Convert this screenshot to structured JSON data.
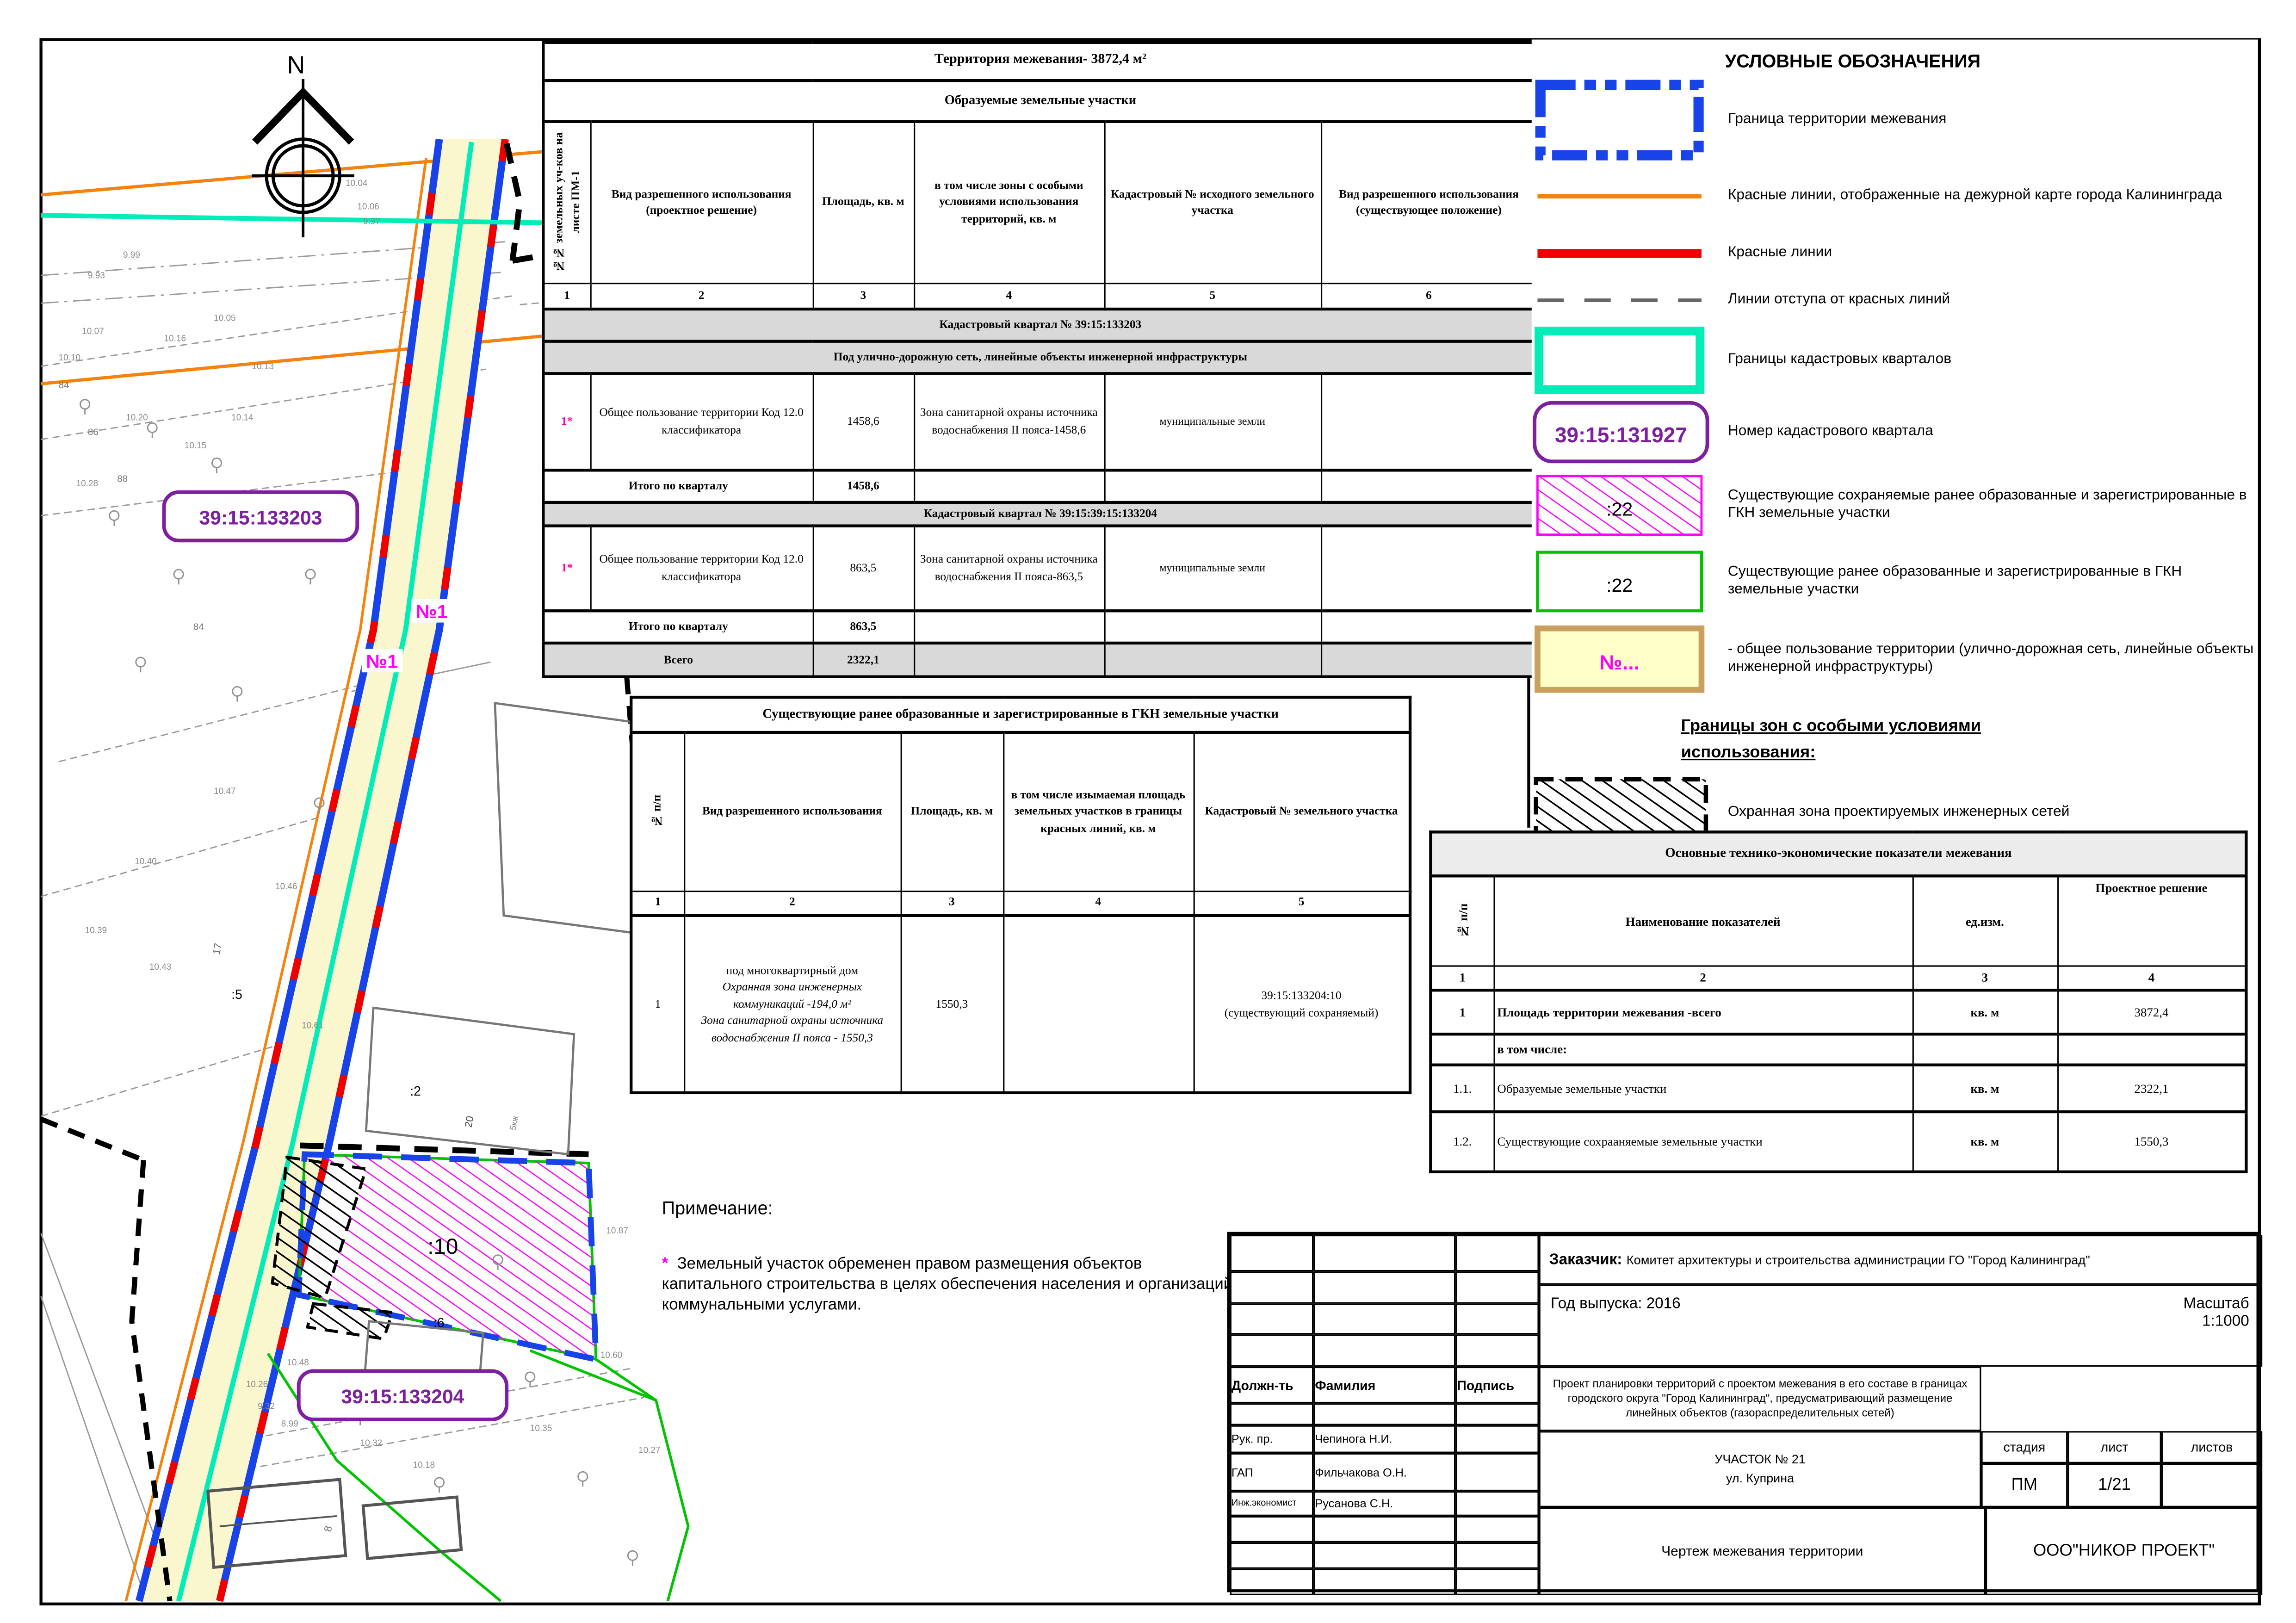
{
  "map": {
    "compass": "N",
    "quarter_label_1": "39:15:133203",
    "quarter_label_2": "39:15:133204",
    "parcel_no1": "№1",
    "parcel_10": ":10",
    "parcel_2": ":2",
    "parcel_5": ":5",
    "parcel_6": ":6",
    "house_17": "17",
    "house_20": "20",
    "house_8": "8",
    "house_84": "84",
    "house_86": "86",
    "house_88": "88",
    "house_5kzh": "5кж",
    "elevations": [
      "10.04",
      "10.06",
      "9.97",
      "9.99",
      "9.93",
      "10.05",
      "10.16",
      "10.07",
      "10.10",
      "10.13",
      "10.20",
      "10.14",
      "10.15",
      "10.28",
      "10.47",
      "10.40",
      "10.46",
      "10.39",
      "10.43",
      "10.61",
      "10.87",
      "10.60",
      "10.45",
      "10.44",
      "10.35",
      "10.27",
      "10.32",
      "10.18",
      "10.48",
      "10.26",
      "9.32",
      "10.36",
      "8.99"
    ]
  },
  "table1": {
    "title": "Территория межевания- 3872,4 м²",
    "subtitle": "Образуемые земельные участки",
    "headers": [
      "№№ земельных уч-ков на листе ПМ-1",
      "Вид разрешенного использования (проектное решение)",
      "Площадь, кв. м",
      "в том числе зоны с особыми условиями использования территорий, кв. м",
      "Кадастровый № исходного земельного участка",
      "Вид разрешенного использования (существующее положение)"
    ],
    "col_numbers": [
      "1",
      "2",
      "3",
      "4",
      "5",
      "6"
    ],
    "section1": "Кадастровый квартал № 39:15:133203",
    "section1_sub": "Под улично-дорожную сеть, линейные объекты инженерной инфраструктуры",
    "row1": {
      "num": "1*",
      "use": "Общее пользование территории Код 12.0 классификатора",
      "area": "1458,6",
      "zone": "Зона санитарной охраны источника водоснабжения II пояса-1458,6",
      "source": "муниципальные земли",
      "existing": ""
    },
    "subtotal1_label": "Итого по кварталу",
    "subtotal1_value": "1458,6",
    "section2": "Кадастровый квартал № 39:15:39:15:133204",
    "row2": {
      "num": "1*",
      "use": "Общее пользование территории Код 12.0 классификатора",
      "area": "863,5",
      "zone": "Зона санитарной охраны источника водоснабжения II пояса-863,5",
      "source": "муниципальные земли",
      "existing": ""
    },
    "subtotal2_label": "Итого по кварталу",
    "subtotal2_value": "863,5",
    "total_label": "Всего",
    "total_value": "2322,1"
  },
  "table2": {
    "title": "Существующие ранее образованные и зарегистрированные в ГКН земельные участки",
    "headers": [
      "№ п/п",
      "Вид разрешенного использования",
      "Площадь, кв. м",
      "в том числе изымаемая площадь земельных участков в границы красных линий, кв. м",
      "Кадастровый № земельного участка"
    ],
    "col_numbers": [
      "1",
      "2",
      "3",
      "4",
      "5"
    ],
    "row": {
      "num": "1",
      "use_line1": "под многоквартирный дом",
      "use_line2": "Охранная зона инженерных коммуникаций -194,0 м²",
      "use_line3": "Зона санитарной охраны источника водоснабжения II пояса - 1550,3",
      "area": "1550,3",
      "seized": "",
      "cadastre_line1": "39:15:133204:10",
      "cadastre_line2": "(существующий сохраняемый)"
    }
  },
  "legend": {
    "title": "УСЛОВНЫЕ ОБОЗНАЧЕНИЯ",
    "items": [
      {
        "label": "Граница территории межевания"
      },
      {
        "label": "Красные линии, отображенные на дежурной карте города Калининграда"
      },
      {
        "label": "Красные линии"
      },
      {
        "label": "Линии отступа от красных линий"
      },
      {
        "label": "Границы кадастровых кварталов"
      },
      {
        "symbol": "39:15:131927",
        "label": "Номер кадастрового квартала"
      },
      {
        "symbol": ":22",
        "label": "Существующие сохраняемые ранее образованные и зарегистрированные в ГКН земельные участки"
      },
      {
        "symbol": ":22",
        "label": "Существующие ранее образованные и зарегистрированные в ГКН земельные участки"
      },
      {
        "symbol": "№...",
        "label": "- общее пользование территории (улично-дорожная сеть, линейные объекты инженерной инфраструктуры)"
      },
      {
        "label": "Охранная зона проектируемых инженерных сетей"
      }
    ],
    "zones_heading": "Границы зон с особыми условиями использования:"
  },
  "tech_table": {
    "title": "Основные технико-экономические показатели межевания",
    "headers": [
      "№ п/п",
      "Наименование показателей",
      "ед.изм.",
      "Проектное решение"
    ],
    "col_numbers": [
      "1",
      "2",
      "3",
      "4"
    ],
    "rows": [
      {
        "num": "1",
        "name": "Площадь территории межевания -всего",
        "unit": "кв. м",
        "value": "3872,4"
      },
      {
        "num": "",
        "name": "в том числе:",
        "unit": "",
        "value": ""
      },
      {
        "num": "1.1.",
        "name": "Образуемые земельные участки",
        "unit": "кв. м",
        "value": "2322,1"
      },
      {
        "num": "1.2.",
        "name": "Существующие сохрааняемые земельные участки",
        "unit": "кв. м",
        "value": "1550,3"
      }
    ]
  },
  "note": {
    "heading": "Примечание:",
    "star": "*",
    "text": "Земельный участок обременен правом размещения объектов капитального строительства в целях обеспечения населения и организаций коммунальными услугами."
  },
  "title_block": {
    "customer_label": "Заказчик:",
    "customer": "Комитет архитектуры и строительства администрации ГО \"Город Калининград\"",
    "year": "Год выпуска: 2016",
    "scale_label": "Масштаб",
    "scale_value": "1:1000",
    "staff_headers": [
      "Должн-ть",
      "Фамилия",
      "Подпись"
    ],
    "staff": [
      {
        "role": "Рук. пр.",
        "name": "Чепинога Н.И."
      },
      {
        "role": "ГАП",
        "name": "Фильчакова О.Н."
      },
      {
        "role": "Инж.экономист",
        "name": "Русанова С.Н."
      }
    ],
    "project": "Проект планировки территорий с проектом межевания в его составе в границах городского округа \"Город Калининград\", предусматривающий размещение линейных объектов (газораспределительных сетей)",
    "site": "УЧАСТОК № 21",
    "street": "ул. Куприна",
    "stage_headers": [
      "стадия",
      "лист",
      "листов"
    ],
    "stage": "ПМ",
    "sheet": "1/21",
    "sheets": "",
    "drawing": "Чертеж межевания территории",
    "company": "ООО\"НИКОР ПРОЕКТ\""
  },
  "colors": {
    "boundary_blue": "#1743e8",
    "red_line": "#ee0000",
    "orange_line": "#f5820a",
    "cyan_line": "#00edb8",
    "magenta": "#ff00ff",
    "purple": "#7d1fa0",
    "green": "#00c400",
    "road_fill": "#faf6cd",
    "legend_yellow": "#ffffc8",
    "section_grey": "#d9d9d9"
  }
}
